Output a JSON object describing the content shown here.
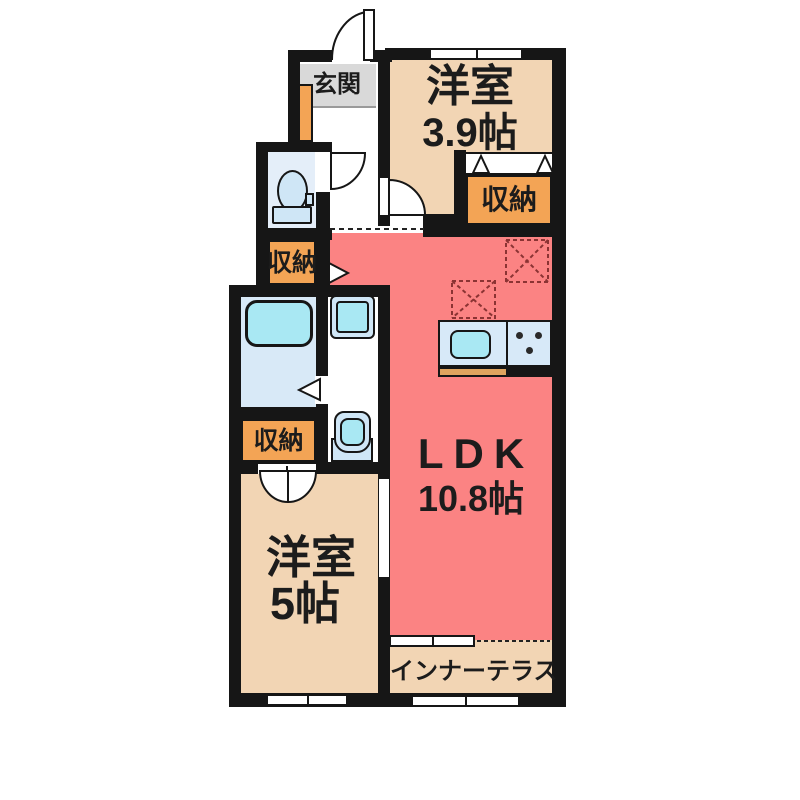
{
  "title": "apartment-floor-plan",
  "rooms": {
    "genkan": {
      "label": "玄関"
    },
    "western_room_39": {
      "name": "洋室",
      "size": "3.9帖"
    },
    "storage_top_right": {
      "label": "収納"
    },
    "storage_left_upper": {
      "label": "収納"
    },
    "storage_left_lower": {
      "label": "収納"
    },
    "ldk": {
      "name": "LDK",
      "size": "10.8帖"
    },
    "western_room_5": {
      "name": "洋室",
      "size": "5帖"
    },
    "inner_terrace": {
      "label": "インナーテラス"
    }
  },
  "colors": {
    "wall": "#161616",
    "ldk_pink": "#fb8383",
    "room_tan": "#f2d5b4",
    "storage_orange": "#f3a455",
    "entrance_gray": "#d9d9d9",
    "fixture_blue": "#cfe6f6",
    "fixture_cyan": "#a9e8f3",
    "counter_wood": "#dfa45f"
  }
}
